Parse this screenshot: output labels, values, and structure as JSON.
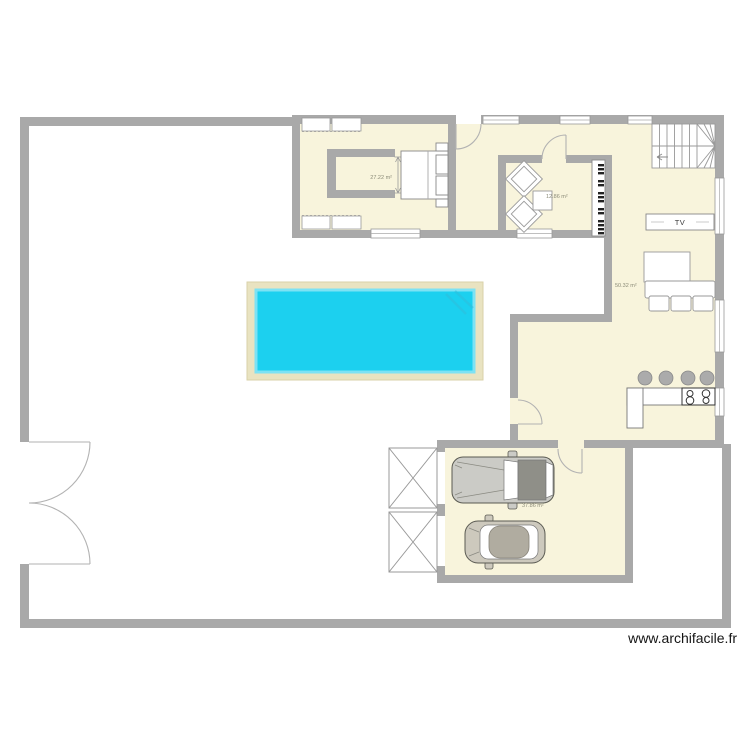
{
  "plan": {
    "watermark": "www.archifacile.fr",
    "rooms": {
      "bedroom": {
        "name": "chambre",
        "area": "27.22 m²"
      },
      "salon": {
        "name": "salon",
        "area": "12.86 m²"
      },
      "living_kitchen": {
        "name": "piece de vie",
        "area": "50.32 m²"
      },
      "garage": {
        "name": "garage",
        "area": "37.86 m²"
      }
    },
    "furniture": {
      "tv_label": "TV"
    },
    "colors": {
      "wall": "#a9a9a9",
      "floor": "#f8f4dc",
      "pool_water": "#1cd0ef",
      "pool_deck": "#e9e3c1",
      "furniture_outline": "#999999"
    }
  }
}
